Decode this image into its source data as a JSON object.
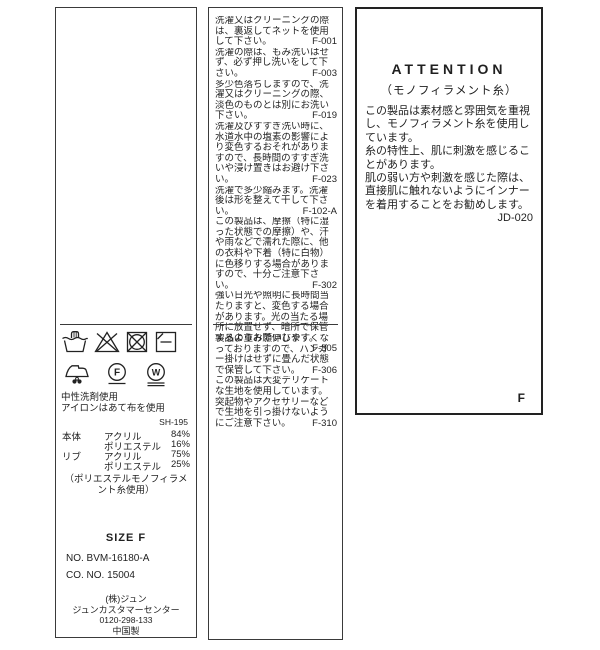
{
  "colors": {
    "border": "#3a3a3a",
    "text": "#1f1f1f",
    "background": "#ffffff"
  },
  "left_label": {
    "care_symbol_icons": [
      "hand-wash-icon",
      "no-bleach-icon",
      "no-tumble-dry-icon",
      "shade-flat-dry-icon",
      "iron-with-cloth-icon",
      "dry-clean-f-icon",
      "wet-clean-w-icon"
    ],
    "circle_letters": [
      "F",
      "W"
    ],
    "washing_notes": [
      "中性洗剤使用",
      "アイロンはあて布を使用"
    ],
    "ref_code": "SH-195",
    "composition": [
      {
        "part": "本体",
        "material": "アクリル",
        "pct": "84%"
      },
      {
        "part": "",
        "material": "ポリエステル",
        "pct": "16%"
      },
      {
        "part": "リブ",
        "material": "アクリル",
        "pct": "75%"
      },
      {
        "part": "",
        "material": "ポリエステル",
        "pct": "25%"
      }
    ],
    "composition_note": "（ポリエステルモノフィラメント糸使用）",
    "size_label": "SIZE F",
    "item_no": "NO. BVM-16180-A",
    "co_no": "CO. NO. 15004",
    "company": "(株)ジュン",
    "customer_center": "ジュンカスタマーセンター",
    "phone": "0120-298-133",
    "origin": "中国製"
  },
  "care_label": {
    "upper_notes": [
      {
        "text": "洗濯又はクリーニングの際は、裏返してネットを使用して下さい。",
        "code": "F-001"
      },
      {
        "text": "洗濯の際は、もみ洗いはせず、必ず押し洗いをして下さい。",
        "code": "F-003"
      },
      {
        "text": "多少色落ちしますので、洗濯又はクリーニングの際、淡色のものとは別にお洗い下さい。",
        "code": "F-019"
      },
      {
        "text": "洗濯及びすすぎ洗い時に、水道水中の塩素の影響により変色するおそれがありますので、長時間のすすぎ洗いや浸け置きはお避け下さい。",
        "code": "F-023"
      },
      {
        "text": "洗濯で多少縮みます。洗濯後は形を整えて干して下さい。",
        "code": "F-102-A"
      },
      {
        "text": "この製品は、摩擦（特に湿った状態での摩擦）や、汗や雨などで濡れた際に、他の衣料や下着（特に白物）に色移りする場合がありますので、十分ご注意下さい。",
        "code": "F-302"
      },
      {
        "text": "強い日光や照明に長時間当たりますと、変色する場合があります。光の当たる場所に放置せず、暗所で保管するようお願いします。",
        "code": "F-305"
      }
    ],
    "lower_notes": [
      {
        "text": "製品の重みで伸びやすくなっておりますので、ハンガー掛けはせずに畳んだ状態で保管して下さい。",
        "code": "F-306"
      },
      {
        "text": "この製品は大変デリケートな生地を使用しています。突起物やアクセサリーなどで生地を引っ掛けないようにご注意下さい。",
        "code": "F-310"
      }
    ]
  },
  "attention_label": {
    "title": "ATTENTION",
    "subtitle": "（モノフィラメント糸）",
    "paragraphs": [
      "この製品は素材感と雰囲気を重視し、モノフィラメント糸を使用しています。",
      "糸の特性上、肌に刺激を感じることがあります。",
      "肌の弱い方や刺激を感じた際は、直接肌に触れないようにインナーを着用することをお勧めします。"
    ],
    "code": "JD-020",
    "size_mark": "F"
  }
}
